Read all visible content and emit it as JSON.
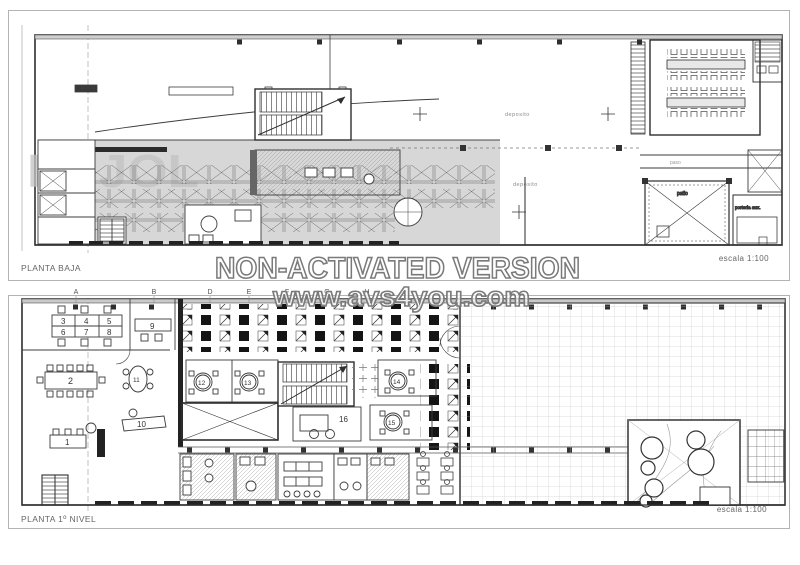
{
  "watermark": {
    "line1": "NON-ACTIVATED VERSION",
    "line2": "www.avs4you.com"
  },
  "plans": {
    "top": {
      "title": "PLANTA BAJA",
      "scale": "escala 1:100",
      "ghost_text": "PUJOL",
      "room_labels": {
        "deposito_upper": "deposito",
        "deposito_lower": "deposito",
        "paso": "paso",
        "patio": "patio",
        "porteria_aux": "porteria aux."
      }
    },
    "bottom": {
      "title": "PLANTA 1º NIVEL",
      "scale": "escala 1:100",
      "grid_letters": {
        "A": "A",
        "B": "B",
        "D": "D",
        "E": "E",
        "F": "F",
        "G": "G",
        "H": "H"
      },
      "room_numbers": {
        "n1": "1",
        "n2": "2",
        "n3": "3",
        "n4": "4",
        "n5": "5",
        "n6": "6",
        "n7": "7",
        "n8": "8",
        "n9": "9",
        "n10": "10",
        "n11": "11",
        "n12": "12",
        "n13": "13",
        "n14": "14",
        "n15": "15",
        "n16": "16"
      }
    }
  },
  "colors": {
    "paper": "#ffffff",
    "frame_border": "#b3b3b3",
    "line_dark": "#2f2f2f",
    "line_mid": "#555555",
    "zone_gray": "#d7d7d7",
    "watermark_outline": "#7a7a7a",
    "ghost_gray": "#c2c2c2"
  }
}
